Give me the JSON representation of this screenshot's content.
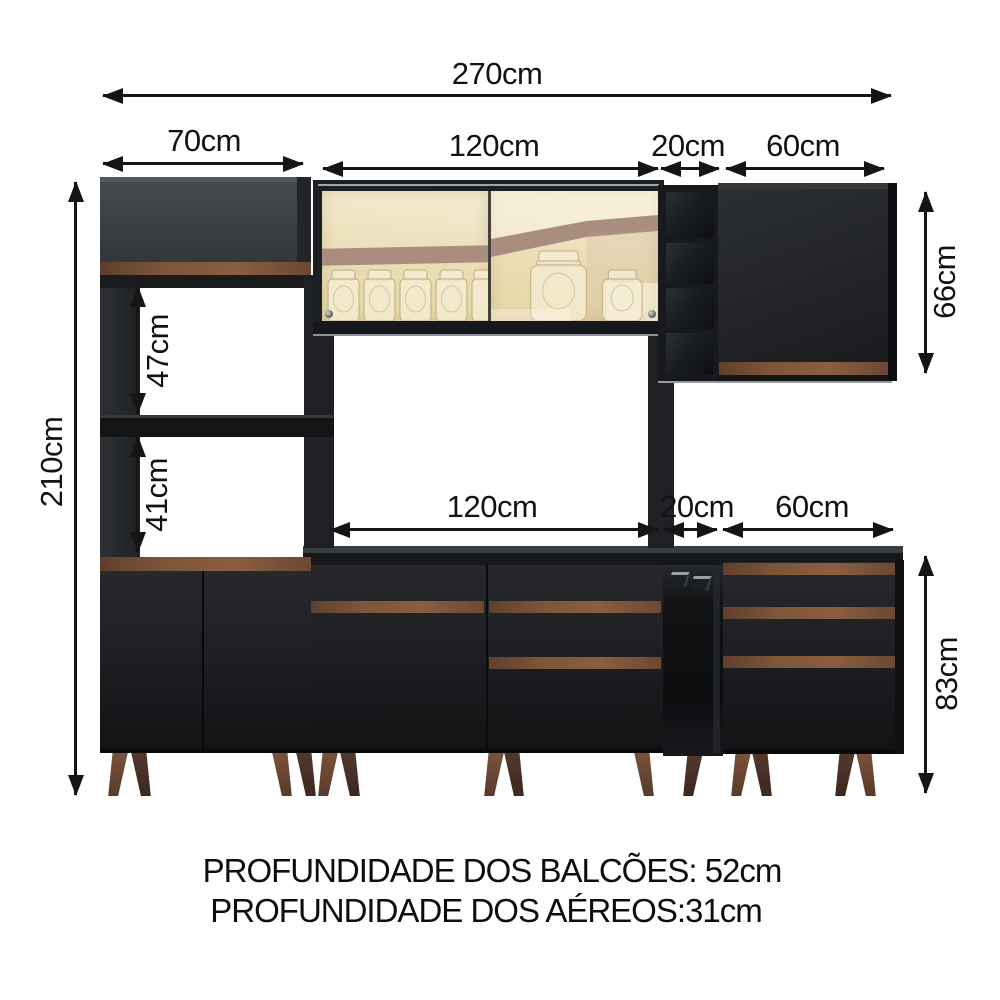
{
  "annotations": {
    "total_width": "270cm",
    "tower_width": "70cm",
    "upper_cabinet_width": "120cm",
    "upper_niche_width": "20cm",
    "upper_right_door_width": "60cm",
    "total_height": "210cm",
    "upper_opening_height": "47cm",
    "lower_opening_height": "41cm",
    "counter_width": "120cm",
    "counter_niche_width": "20cm",
    "counter_drawer_unit_width": "60cm",
    "upper_right_cabinet_height": "66cm",
    "counter_height": "83cm"
  },
  "footnotes": {
    "balcoes": "PROFUNDIDADE DOS BALCÕES: 52cm",
    "aereos": "PROFUNDIDADE DOS AÉREOS:31cm"
  },
  "colors": {
    "cabinet_black": "#202225",
    "wood_accent": "#7b553b",
    "glass_reflection_cream": "#ecdfb8",
    "leg_wood": "#6a4833",
    "dimension_lines": "#151515",
    "background": "#ffffff"
  }
}
